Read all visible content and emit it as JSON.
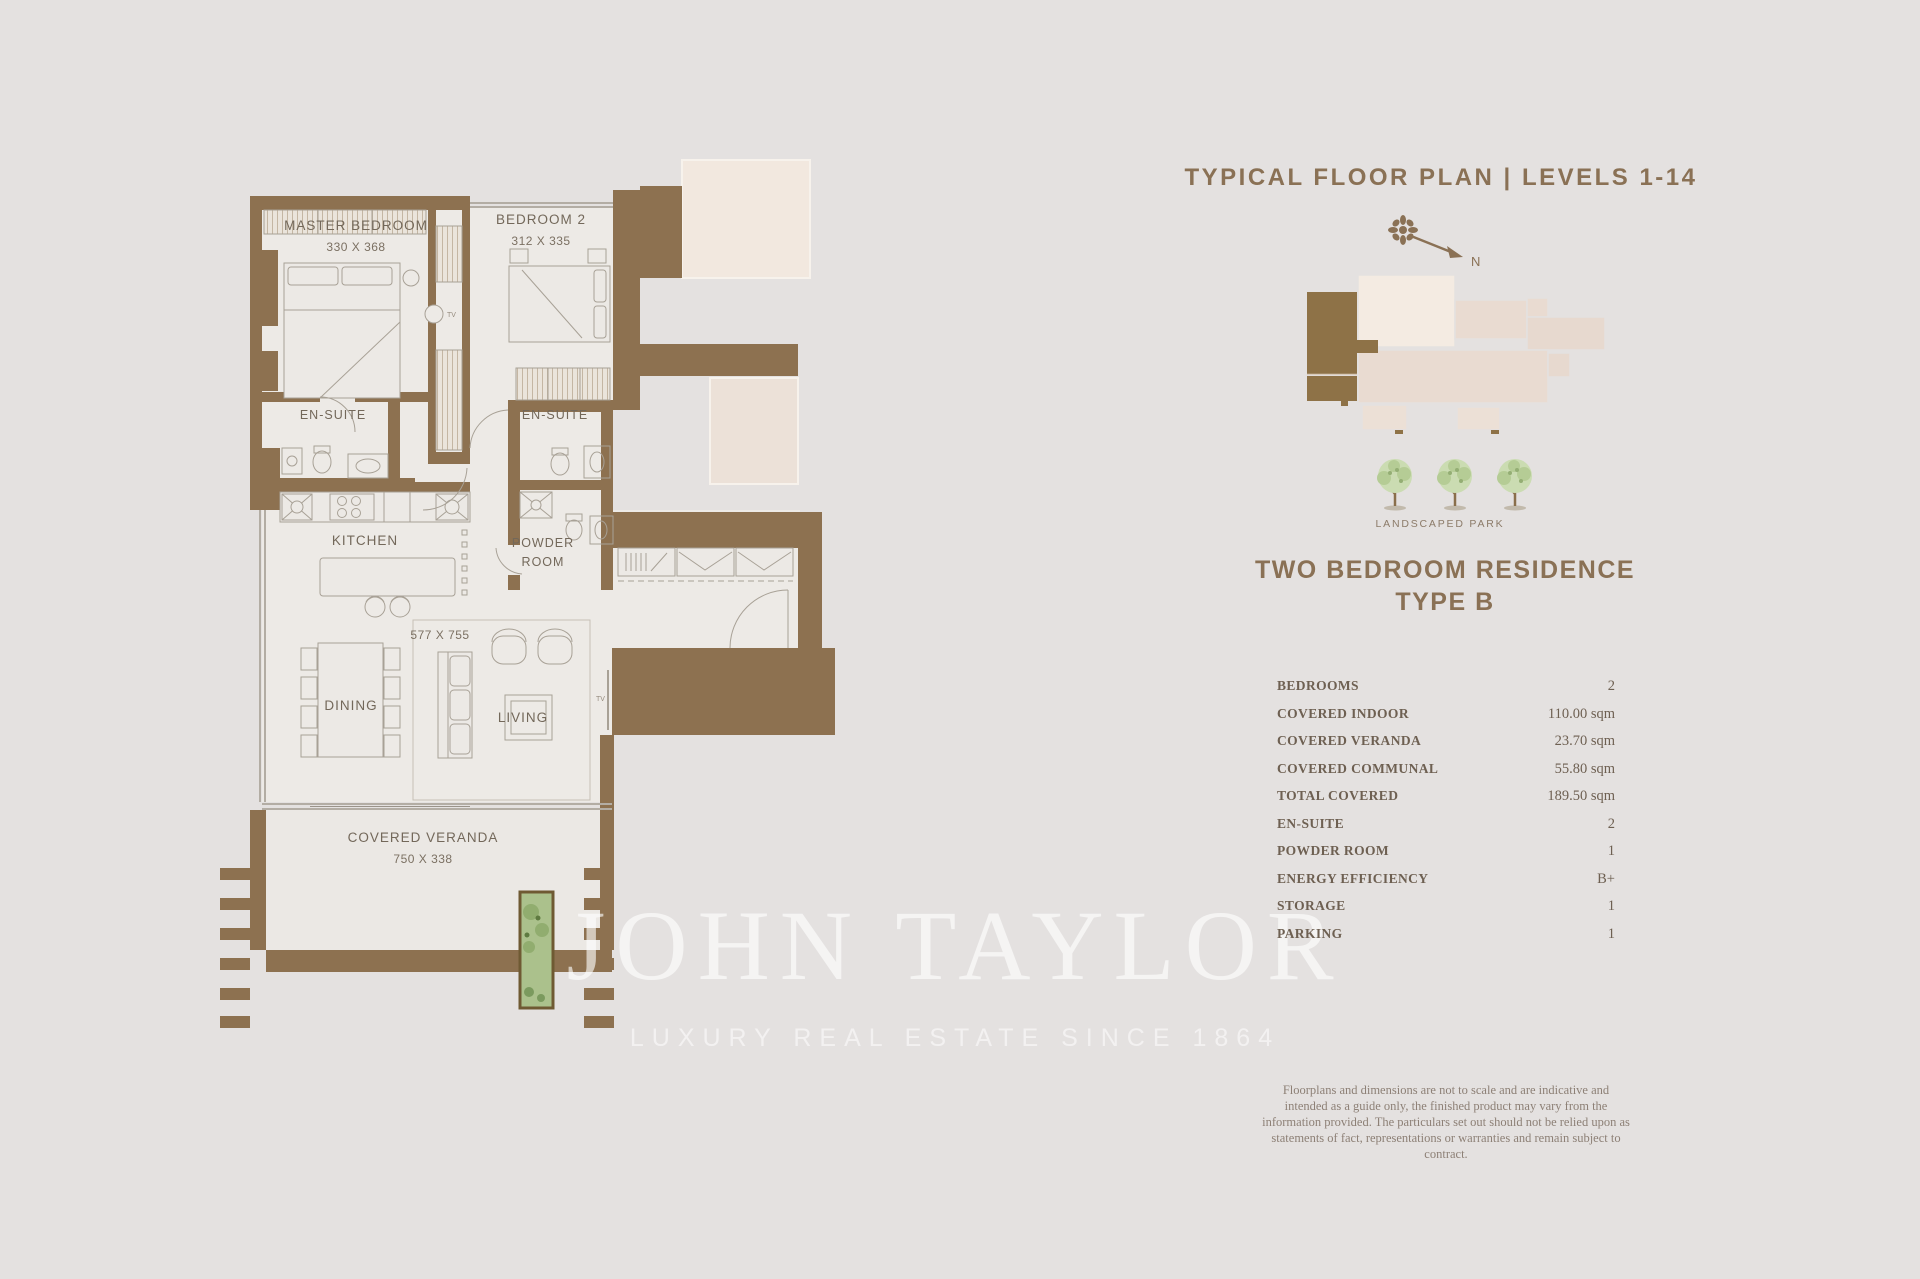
{
  "page": {
    "background": "#e4e1e0"
  },
  "panel": {
    "title": "TYPICAL FLOOR PLAN | LEVELS 1-14",
    "compass_north_label": "N",
    "landscaped_park_label": "LANDSCAPED PARK",
    "residence_title_line1": "TWO BEDROOM RESIDENCE",
    "residence_title_line2": "TYPE B",
    "specs": [
      {
        "label": "BEDROOMS",
        "value": "2"
      },
      {
        "label": "COVERED INDOOR",
        "value": "110.00 sqm"
      },
      {
        "label": "COVERED VERANDA",
        "value": "23.70 sqm"
      },
      {
        "label": "COVERED COMMUNAL",
        "value": "55.80 sqm"
      },
      {
        "label": "TOTAL COVERED",
        "value": "189.50 sqm"
      },
      {
        "label": "EN-SUITE",
        "value": "2"
      },
      {
        "label": "POWDER ROOM",
        "value": "1"
      },
      {
        "label": "ENERGY EFFICIENCY",
        "value": "B+"
      },
      {
        "label": "STORAGE",
        "value": "1"
      },
      {
        "label": "PARKING",
        "value": "1"
      }
    ],
    "disclaimer": "Floorplans and dimensions are not to scale and are indicative and intended as a guide only, the finished product may vary from the information provided. The particulars set out should not be relied upon as statements of fact, representations or warranties and remain subject to contract."
  },
  "floorplan": {
    "tv_label": "TV",
    "rooms": [
      {
        "id": "master-bedroom",
        "name": "MASTER BEDROOM",
        "dims": "330 X 368"
      },
      {
        "id": "bedroom-2",
        "name": "BEDROOM 2",
        "dims": "312 X 335"
      },
      {
        "id": "ensuite-left",
        "name": "EN-SUITE"
      },
      {
        "id": "ensuite-right",
        "name": "EN-SUITE"
      },
      {
        "id": "kitchen",
        "name": "KITCHEN"
      },
      {
        "id": "powder-room",
        "name": "POWDER ROOM"
      },
      {
        "id": "living-dining",
        "dims": "577 X 755"
      },
      {
        "id": "dining",
        "name": "DINING"
      },
      {
        "id": "living",
        "name": "LIVING"
      },
      {
        "id": "covered-veranda",
        "name": "COVERED VERANDA",
        "dims": "750 X 338"
      }
    ]
  },
  "watermark": {
    "brand": "JOHN TAYLOR",
    "tagline": "LUXURY REAL ESTATE SINCE 1864"
  },
  "colors": {
    "background": "#e4e1e0",
    "wall_brown": "#8d7150",
    "accent_brown": "#8a7155",
    "keyplan_highlight": "#8e7247",
    "tree_green": "#cbdcb2",
    "planter_green": "#abc18c"
  }
}
